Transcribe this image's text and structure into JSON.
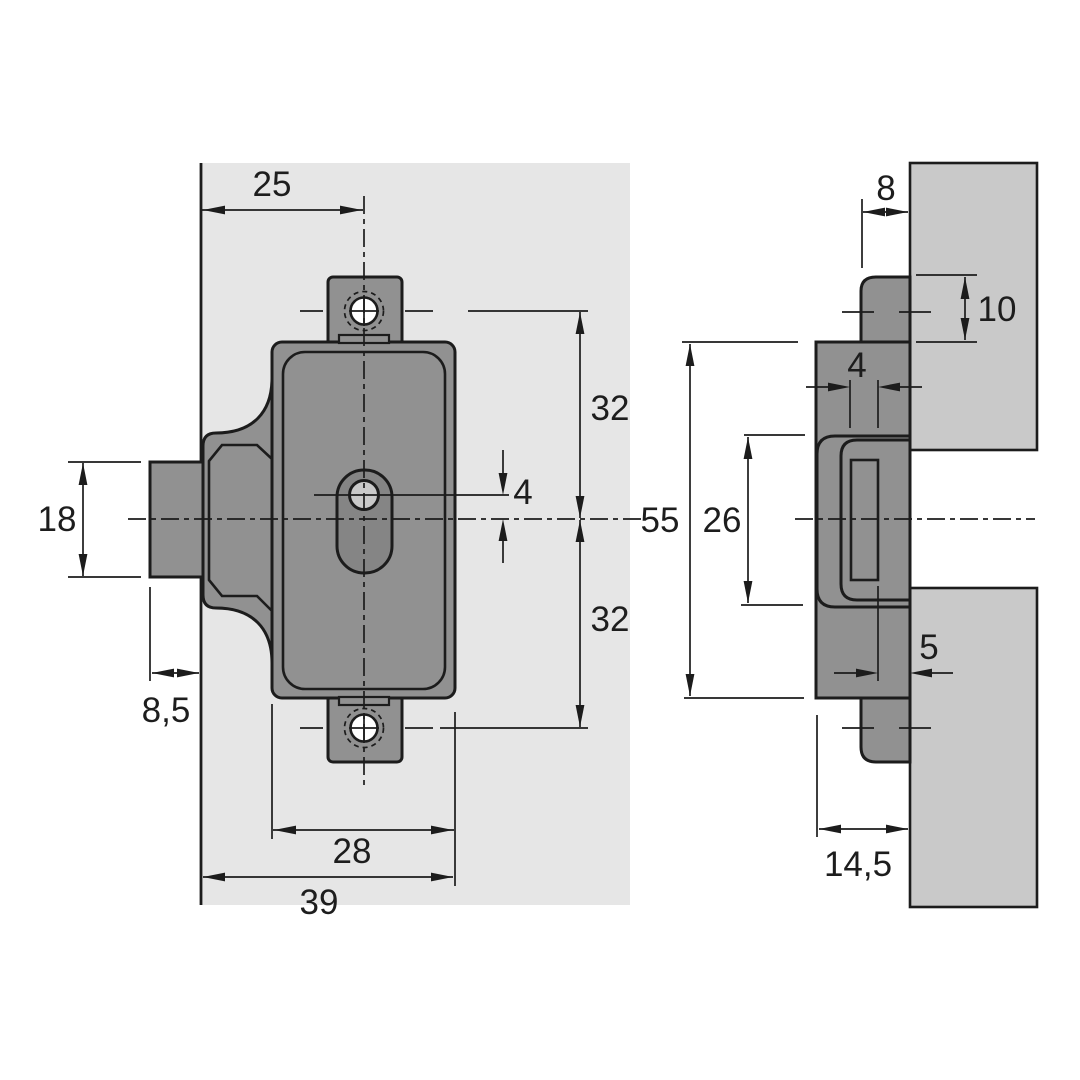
{
  "drawing": {
    "type": "technical-dimension-drawing",
    "subject": "furniture cam lock, front view and side section view",
    "colors": {
      "background": "#ffffff",
      "front_panel": "#e6e6e6",
      "side_panel": "#c9c9c9",
      "lock_body": "#919191",
      "keyhole_oval": "#858585",
      "keyhole_circle": "#c9c9c9",
      "screw_hole": "#ffffff",
      "line": "#1c1c1c"
    },
    "front_view": {
      "dim_edge_to_center": "25",
      "dim_center_to_top_screw": "32",
      "dim_center_to_bottom_screw": "32",
      "dim_cylinder_offset": "4",
      "dim_latch_height": "18",
      "dim_latch_protrusion": "8,5",
      "dim_body_width": "28",
      "dim_total_width": "39"
    },
    "side_view": {
      "dim_flange_depth": "8",
      "dim_tab_height": "10",
      "dim_slot_width": "4",
      "dim_total_height": "55",
      "dim_inner_height": "26",
      "dim_slot_to_face": "5",
      "dim_total_depth": "14,5"
    }
  }
}
